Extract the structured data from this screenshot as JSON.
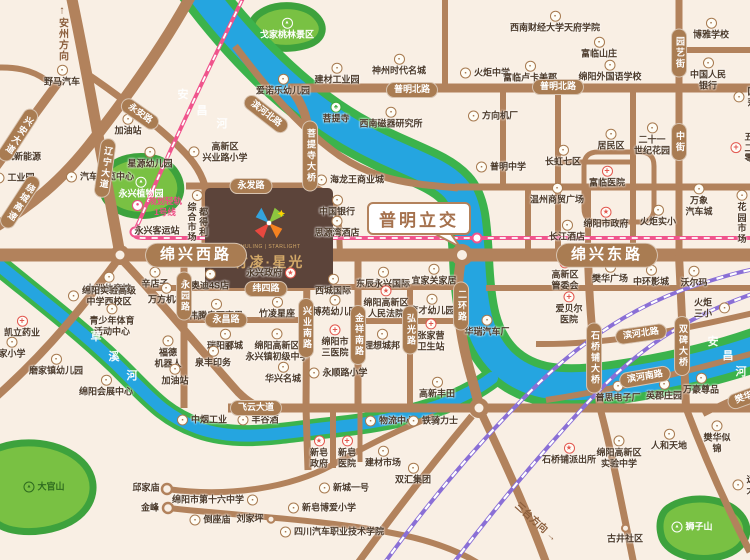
{
  "map": {
    "property": {
      "name_cn": "竹凌·星光",
      "name_en": "ZHULING | STARLIGHT"
    },
    "interchange": {
      "label": "普明立交"
    },
    "metro": {
      "line1": "规划轻轨",
      "line2": "1号线"
    },
    "colors": {
      "road": "#b2825c",
      "river": "#25a5e0",
      "bank": "#3cb34c",
      "rail": "#8a6fd6",
      "metro": "#f0548c",
      "accent_red": "#e2574e",
      "property_bg": "#5c443a",
      "gold": "#d2a868"
    },
    "directions": [
      {
        "t": "安州方向",
        "x": 62,
        "y": 33,
        "v": true,
        "arrow": "↑"
      },
      {
        "t": "三台方向",
        "x": 537,
        "y": 521,
        "rot": 42,
        "arrow": "→"
      }
    ],
    "river_chars": [
      {
        "ch": "安",
        "x": 183,
        "y": 94
      },
      {
        "ch": "昌",
        "x": 202,
        "y": 110
      },
      {
        "ch": "河",
        "x": 222,
        "y": 123
      },
      {
        "ch": "草",
        "x": 96,
        "y": 336
      },
      {
        "ch": "溪",
        "x": 114,
        "y": 356
      },
      {
        "ch": "河",
        "x": 132,
        "y": 375
      },
      {
        "ch": "安",
        "x": 713,
        "y": 341
      },
      {
        "ch": "昌",
        "x": 728,
        "y": 355
      },
      {
        "ch": "河",
        "x": 741,
        "y": 371
      }
    ],
    "road_labels": [
      {
        "t": "绵兴西路",
        "x": 196,
        "y": 255,
        "big": true
      },
      {
        "t": "绵兴东路",
        "x": 607,
        "y": 255,
        "big": true
      },
      {
        "t": "普明北路",
        "x": 412,
        "y": 90
      },
      {
        "t": "普明北路",
        "x": 558,
        "y": 87
      },
      {
        "t": "永发路",
        "x": 251,
        "y": 186
      },
      {
        "t": "纬四路",
        "x": 266,
        "y": 289
      },
      {
        "t": "永昌路",
        "x": 226,
        "y": 320
      },
      {
        "t": "飞云大道",
        "x": 256,
        "y": 408
      },
      {
        "t": "滨河北路",
        "x": 266,
        "y": 114,
        "rot": 38
      },
      {
        "t": "滨河北路",
        "x": 641,
        "y": 334,
        "rot": -8
      },
      {
        "t": "滨河南路",
        "x": 645,
        "y": 377,
        "rot": -10
      },
      {
        "t": "永安路",
        "x": 140,
        "y": 114,
        "rot": 35
      },
      {
        "t": "兴安大道",
        "x": 18,
        "y": 135,
        "v": true,
        "rot": 33
      },
      {
        "t": "绕城高速",
        "x": 20,
        "y": 202,
        "v": true,
        "rot": 33
      },
      {
        "t": "辽宁大道",
        "x": 105,
        "y": 168,
        "v": true,
        "rot": 8
      },
      {
        "t": "菩提寺大桥",
        "x": 310,
        "y": 156,
        "v": true
      },
      {
        "t": "兴业南路",
        "x": 306,
        "y": 328,
        "v": true
      },
      {
        "t": "金祥南路",
        "x": 358,
        "y": 335,
        "v": true
      },
      {
        "t": "弘光路",
        "x": 410,
        "y": 330,
        "v": true
      },
      {
        "t": "二环路",
        "x": 461,
        "y": 306,
        "v": true
      },
      {
        "t": "永园路",
        "x": 184,
        "y": 296,
        "v": true
      },
      {
        "t": "园艺街",
        "x": 679,
        "y": 53,
        "v": true
      },
      {
        "t": "中街",
        "x": 679,
        "y": 142,
        "v": true
      },
      {
        "t": "石桥铺大桥",
        "x": 594,
        "y": 358,
        "v": true
      },
      {
        "t": "双碑大桥",
        "x": 682,
        "y": 346,
        "v": true
      },
      {
        "t": "樊华",
        "x": 744,
        "y": 398,
        "rot": -20
      }
    ],
    "pois": [
      {
        "t": "野马汽车",
        "x": 62,
        "y": 76,
        "i": "b",
        "p": "top"
      },
      {
        "t": "加油站",
        "x": 128,
        "y": 125,
        "i": "b",
        "p": "top"
      },
      {
        "t": "星源幼儿园",
        "x": 150,
        "y": 158,
        "i": "b",
        "p": "top"
      },
      {
        "t": "高新区\n兴业路小学",
        "x": 218,
        "y": 152,
        "i": "b",
        "p": "left"
      },
      {
        "t": "汽车博览中心",
        "x": 100,
        "y": 177,
        "i": "b",
        "p": "left"
      },
      {
        "t": "工业园",
        "x": 14,
        "y": 178,
        "i": "b",
        "p": "left"
      },
      {
        "t": "航新能源",
        "x": 16,
        "y": 157,
        "i": "b",
        "p": "left"
      },
      {
        "t": "永兴客运站",
        "x": 157,
        "y": 231,
        "i": "none",
        "p": "top"
      },
      {
        "t": "都得利\n综合市场",
        "x": 197,
        "y": 216,
        "i": "b",
        "p": "top",
        "vc": true
      },
      {
        "t": "戈家桃林景区",
        "x": 287,
        "y": 29,
        "i": "park",
        "p": "top"
      },
      {
        "t": "永兴植物园",
        "x": 141,
        "y": 188,
        "i": "park",
        "p": "top"
      },
      {
        "t": "大官山",
        "x": 44,
        "y": 487,
        "i": "hill",
        "p": "left"
      },
      {
        "t": "狮子山",
        "x": 692,
        "y": 527,
        "i": "park",
        "p": "left"
      },
      {
        "t": "爱诺乐幼儿园",
        "x": 283,
        "y": 85,
        "i": "b",
        "p": "top"
      },
      {
        "t": "建材工业园",
        "x": 337,
        "y": 74,
        "i": "b",
        "p": "top"
      },
      {
        "t": "神州时代名城",
        "x": 399,
        "y": 65,
        "i": "b",
        "p": "top"
      },
      {
        "t": "菩提寺",
        "x": 336,
        "y": 113,
        "i": "t",
        "p": "top"
      },
      {
        "t": "西南磁器研究所",
        "x": 391,
        "y": 118,
        "i": "b",
        "p": "top"
      },
      {
        "t": "海龙王商业城",
        "x": 350,
        "y": 180,
        "i": "b",
        "p": "left"
      },
      {
        "t": "中国银行",
        "x": 337,
        "y": 206,
        "i": "b",
        "p": "top"
      },
      {
        "t": "思源湾酒店",
        "x": 337,
        "y": 227,
        "i": "b",
        "p": "top"
      },
      {
        "t": "火炬中学",
        "x": 485,
        "y": 73,
        "i": "b",
        "p": "left"
      },
      {
        "t": "富临卢卡美郡",
        "x": 530,
        "y": 72,
        "i": "b",
        "p": "top"
      },
      {
        "t": "西南财经大学天府学院",
        "x": 555,
        "y": 22,
        "i": "b",
        "p": "top"
      },
      {
        "t": "富临山庄",
        "x": 599,
        "y": 48,
        "i": "b",
        "p": "top"
      },
      {
        "t": "绵阳外国语学校",
        "x": 610,
        "y": 71,
        "i": "b",
        "p": "top"
      },
      {
        "t": "博雅学校",
        "x": 711,
        "y": 29,
        "i": "b",
        "p": "top"
      },
      {
        "t": "中国人民银行",
        "x": 708,
        "y": 74,
        "i": "b",
        "p": "top"
      },
      {
        "t": "国莎",
        "x": 745,
        "y": 97,
        "i": "b",
        "p": "left"
      },
      {
        "t": "方向机厂",
        "x": 493,
        "y": 116,
        "i": "b",
        "p": "left"
      },
      {
        "t": "普明中学",
        "x": 501,
        "y": 167,
        "i": "b",
        "p": "left"
      },
      {
        "t": "长虹七区",
        "x": 563,
        "y": 156,
        "i": "b",
        "p": "top"
      },
      {
        "t": "富临医院",
        "x": 607,
        "y": 177,
        "i": "h",
        "p": "top"
      },
      {
        "t": "居民区",
        "x": 611,
        "y": 140,
        "i": "b",
        "p": "top"
      },
      {
        "t": "二十一\n世纪花园",
        "x": 652,
        "y": 139,
        "i": "b",
        "p": "top"
      },
      {
        "t": "五二零",
        "x": 742,
        "y": 148,
        "i": "h",
        "p": "left"
      },
      {
        "t": "温州商贸广场",
        "x": 557,
        "y": 194,
        "i": "b",
        "p": "top"
      },
      {
        "t": "绵阳市政府",
        "x": 606,
        "y": 218,
        "i": "g",
        "p": "top"
      },
      {
        "t": "长江酒店",
        "x": 567,
        "y": 231,
        "i": "b",
        "p": "top"
      },
      {
        "t": "火炬实小",
        "x": 658,
        "y": 216,
        "i": "b",
        "p": "top"
      },
      {
        "t": "万象\n汽车城",
        "x": 699,
        "y": 200,
        "i": "b",
        "p": "top"
      },
      {
        "t": "花园市场",
        "x": 742,
        "y": 217,
        "i": "b",
        "p": "top"
      },
      {
        "t": "永兴政府",
        "x": 271,
        "y": 273,
        "i": "g",
        "p": "right"
      },
      {
        "t": "西城国际",
        "x": 333,
        "y": 285,
        "i": "b",
        "p": "top"
      },
      {
        "t": "东辰永兴国际",
        "x": 383,
        "y": 278,
        "i": "b",
        "p": "top"
      },
      {
        "t": "宜家关家居",
        "x": 434,
        "y": 275,
        "i": "b",
        "p": "top"
      },
      {
        "t": "奥迪4S店",
        "x": 210,
        "y": 280,
        "i": "b",
        "p": "top"
      },
      {
        "t": "辛店子",
        "x": 155,
        "y": 278,
        "i": "b",
        "p": "top"
      },
      {
        "t": "万方机械",
        "x": 166,
        "y": 294,
        "i": "b",
        "p": "top"
      },
      {
        "t": "伟腾奥西赛恩",
        "x": 216,
        "y": 310,
        "i": "b",
        "p": "top"
      },
      {
        "t": "竹凌星座",
        "x": 277,
        "y": 308,
        "i": "b",
        "p": "top"
      },
      {
        "t": "博苑幼儿园",
        "x": 335,
        "y": 306,
        "i": "b",
        "p": "top"
      },
      {
        "t": "绵阳高新区\n人民法院",
        "x": 386,
        "y": 302,
        "i": "g",
        "p": "top"
      },
      {
        "t": "育才幼儿园",
        "x": 432,
        "y": 305,
        "i": "b",
        "p": "top"
      },
      {
        "t": "华瑞汽车厂",
        "x": 487,
        "y": 326,
        "i": "b",
        "p": "top"
      },
      {
        "t": "瑞阳郦城",
        "x": 225,
        "y": 340,
        "i": "b",
        "p": "top"
      },
      {
        "t": "绵阳高新区\n永兴镇初级中学",
        "x": 277,
        "y": 345,
        "i": "b",
        "p": "top"
      },
      {
        "t": "绵阳市\n三医院",
        "x": 335,
        "y": 341,
        "i": "h",
        "p": "top"
      },
      {
        "t": "理想城邦",
        "x": 382,
        "y": 340,
        "i": "b",
        "p": "top"
      },
      {
        "t": "张家营\n卫生站",
        "x": 431,
        "y": 335,
        "i": "h",
        "p": "top"
      },
      {
        "t": "泉丰印务",
        "x": 213,
        "y": 357,
        "i": "b",
        "p": "top"
      },
      {
        "t": "福德\n机器人",
        "x": 168,
        "y": 352,
        "i": "b",
        "p": "top"
      },
      {
        "t": "加油站",
        "x": 175,
        "y": 375,
        "i": "b",
        "p": "top"
      },
      {
        "t": "华兴名城",
        "x": 283,
        "y": 373,
        "i": "b",
        "p": "top"
      },
      {
        "t": "永顺路小学",
        "x": 338,
        "y": 373,
        "i": "b",
        "p": "left"
      },
      {
        "t": "高新区\n管委会",
        "x": 565,
        "y": 274,
        "i": "g",
        "p": "top"
      },
      {
        "t": "樊华广场",
        "x": 610,
        "y": 273,
        "i": "b",
        "p": "top"
      },
      {
        "t": "中环影城",
        "x": 651,
        "y": 276,
        "i": "b",
        "p": "top"
      },
      {
        "t": "沃尔玛",
        "x": 694,
        "y": 277,
        "i": "b",
        "p": "top"
      },
      {
        "t": "爱贝尔\n医院",
        "x": 569,
        "y": 308,
        "i": "h",
        "p": "top"
      },
      {
        "t": "火炬三小",
        "x": 710,
        "y": 308,
        "i": "b",
        "p": "right"
      },
      {
        "t": "凯立药业",
        "x": 22,
        "y": 327,
        "i": "h",
        "p": "top"
      },
      {
        "t": "九洲体育馆",
        "x": 109,
        "y": 283,
        "i": "b",
        "p": "top"
      },
      {
        "t": "绵阳实验高级\n中学西校区",
        "x": 102,
        "y": 296,
        "i": "b",
        "p": "left"
      },
      {
        "t": "青少年体育\n活动中心",
        "x": 112,
        "y": 320,
        "i": "b",
        "p": "top"
      },
      {
        "t": "家小学",
        "x": 12,
        "y": 348,
        "i": "b",
        "p": "top"
      },
      {
        "t": "磨家镇幼儿园",
        "x": 56,
        "y": 365,
        "i": "b",
        "p": "top"
      },
      {
        "t": "绵阳会展中心",
        "x": 106,
        "y": 386,
        "i": "b",
        "p": "top"
      },
      {
        "t": "中烟工业",
        "x": 202,
        "y": 420,
        "i": "b",
        "p": "left"
      },
      {
        "t": "丰谷酒",
        "x": 258,
        "y": 420,
        "i": "b",
        "p": "left"
      },
      {
        "t": "物流中心",
        "x": 390,
        "y": 421,
        "i": "b",
        "p": "left"
      },
      {
        "t": "铁骑力士",
        "x": 433,
        "y": 421,
        "i": "b",
        "p": "left"
      },
      {
        "t": "高新丰田",
        "x": 437,
        "y": 388,
        "i": "b",
        "p": "top"
      },
      {
        "t": "新皂\n政府",
        "x": 319,
        "y": 452,
        "i": "g",
        "p": "top"
      },
      {
        "t": "新皂\n医院",
        "x": 347,
        "y": 452,
        "i": "h",
        "p": "top"
      },
      {
        "t": "建材市场",
        "x": 383,
        "y": 457,
        "i": "b",
        "p": "top"
      },
      {
        "t": "双汇集团",
        "x": 413,
        "y": 474,
        "i": "b",
        "p": "top"
      },
      {
        "t": "新城一号",
        "x": 344,
        "y": 488,
        "i": "b",
        "p": "left"
      },
      {
        "t": "绵阳市第十六中学",
        "x": 215,
        "y": 500,
        "i": "b",
        "p": "right"
      },
      {
        "t": "邱家庙",
        "x": 146,
        "y": 488,
        "i": "none",
        "p": "top"
      },
      {
        "t": "金峰",
        "x": 150,
        "y": 508,
        "i": "none",
        "p": "top"
      },
      {
        "t": "倒座庙",
        "x": 210,
        "y": 520,
        "i": "b",
        "p": "left"
      },
      {
        "t": "刘家坪",
        "x": 256,
        "y": 519,
        "i": "ring",
        "p": "right"
      },
      {
        "t": "新皂博爱小学",
        "x": 322,
        "y": 508,
        "i": "b",
        "p": "left"
      },
      {
        "t": "四川汽车职业技术学院",
        "x": 332,
        "y": 532,
        "i": "b",
        "p": "left"
      },
      {
        "t": "普思电子厂",
        "x": 618,
        "y": 392,
        "i": "b",
        "p": "top"
      },
      {
        "t": "英郡庄园",
        "x": 664,
        "y": 390,
        "i": "b",
        "p": "top"
      },
      {
        "t": "万豪尊品",
        "x": 701,
        "y": 384,
        "i": "b",
        "p": "top"
      },
      {
        "t": "石桥铺派出所",
        "x": 569,
        "y": 454,
        "i": "g",
        "p": "top"
      },
      {
        "t": "绵阳高新区\n实验中学",
        "x": 619,
        "y": 452,
        "i": "b",
        "p": "top"
      },
      {
        "t": "人和天地",
        "x": 669,
        "y": 440,
        "i": "b",
        "p": "top"
      },
      {
        "t": "樊华似锦",
        "x": 717,
        "y": 437,
        "i": "b",
        "p": "top"
      },
      {
        "t": "远大",
        "x": 744,
        "y": 485,
        "i": "b",
        "p": "left"
      },
      {
        "t": "古井社区",
        "x": 625,
        "y": 534,
        "i": "ring",
        "p": "top"
      }
    ]
  }
}
